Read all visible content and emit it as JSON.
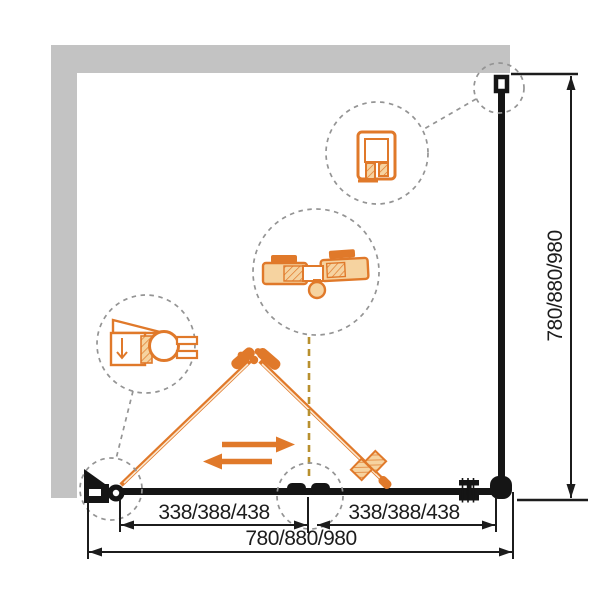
{
  "drawing": {
    "kind": "shower-enclosure-bifold-corner-plan",
    "dimensions": {
      "total_width": "780/880/980",
      "segment_left": "338/388/438",
      "segment_right": "338/388/438",
      "total_depth": "780/880/980"
    },
    "colors": {
      "wall_gray": "#c3c3c3",
      "frame_black": "#151515",
      "accent_orange": "#e0792a",
      "accent_orange_light": "#f6d3a0",
      "callout_dash_gray": "#949494",
      "centerline_olive": "#b8902f",
      "dimension_text": "#1c1c1c",
      "background": "#ffffff"
    },
    "callouts": [
      {
        "icon": "wall-profile-section-icon"
      },
      {
        "icon": "wall-profile-plan-icon"
      },
      {
        "icon": "fold-hinge-section-icon"
      },
      {
        "icon": "wall-pivot-hinge-icon"
      },
      {
        "icon": "corner-pivot-plan-icon"
      },
      {
        "icon": "floor-guide-plan-icon"
      }
    ]
  }
}
